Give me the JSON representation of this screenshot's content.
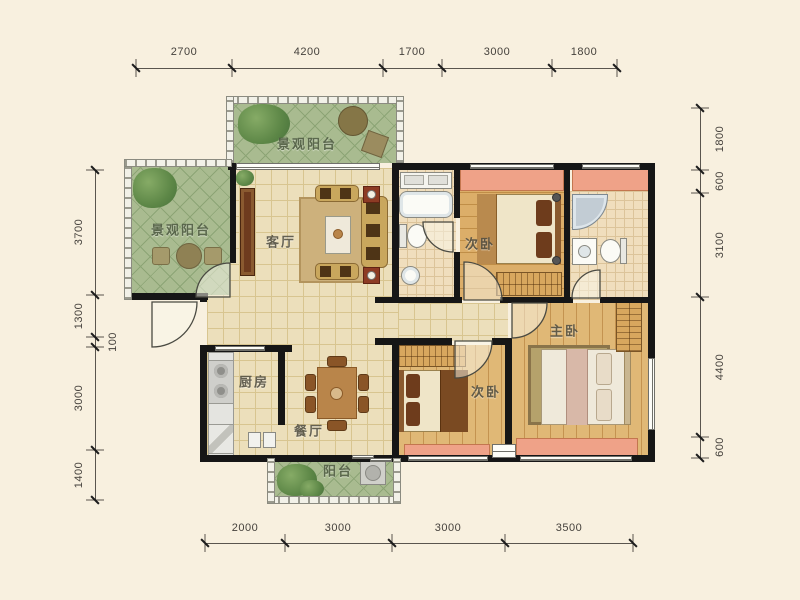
{
  "plan": {
    "rooms": {
      "balcony_top": {
        "label": "景观阳台"
      },
      "balcony_left": {
        "label": "景观阳台"
      },
      "living_room": {
        "label": "客厅"
      },
      "bedroom_top": {
        "label": "次卧"
      },
      "master_bedroom": {
        "label": "主卧"
      },
      "bedroom_second": {
        "label": "次卧"
      },
      "kitchen": {
        "label": "厨房"
      },
      "dining_room": {
        "label": "餐厅"
      },
      "balcony_bottom": {
        "label": "阳台"
      }
    },
    "dimensions": {
      "top": [
        "2700",
        "4200",
        "1700",
        "3000",
        "1800"
      ],
      "bottom": [
        "2000",
        "3000",
        "3000",
        "3500"
      ],
      "left": [
        "3700",
        "1300",
        "100",
        "3000",
        "1400"
      ],
      "right": [
        "1800",
        "600",
        "3100",
        "4400",
        "600"
      ]
    },
    "colors": {
      "background": "#f8f0df",
      "wall": "#161616",
      "bay_window": "#efa288",
      "balcony_tile": "#a9bb90",
      "floor_tile": "#ecdfbb",
      "bedroom_wood": "#dcae69",
      "bath_tile": "#f0debd"
    }
  }
}
